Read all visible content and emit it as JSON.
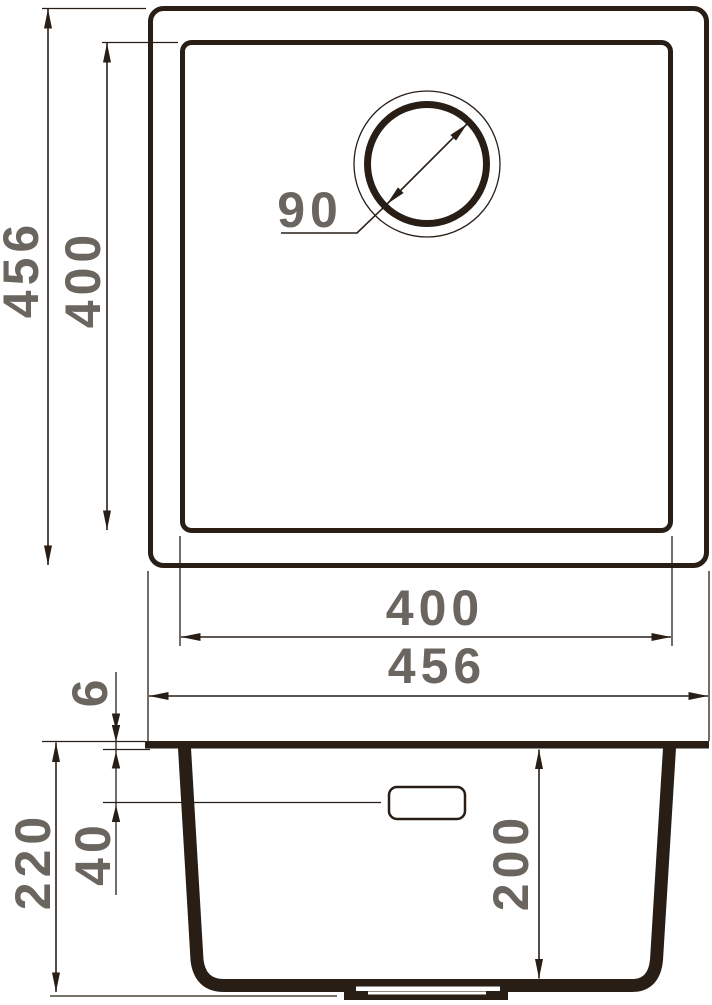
{
  "drawing": {
    "kind": "sink-dimension-drawing",
    "views": {
      "top": {
        "outer_height": "456",
        "inner_height": "400",
        "drain_diameter": "90",
        "inner_width": "400",
        "outer_width": "456"
      },
      "side": {
        "rim_thickness": "6",
        "overall_height": "220",
        "overflow_drop": "40",
        "bowl_depth": "200"
      }
    },
    "colors": {
      "line": "#281e16",
      "dimension_text": "#6b6560",
      "background": "#ffffff"
    }
  }
}
